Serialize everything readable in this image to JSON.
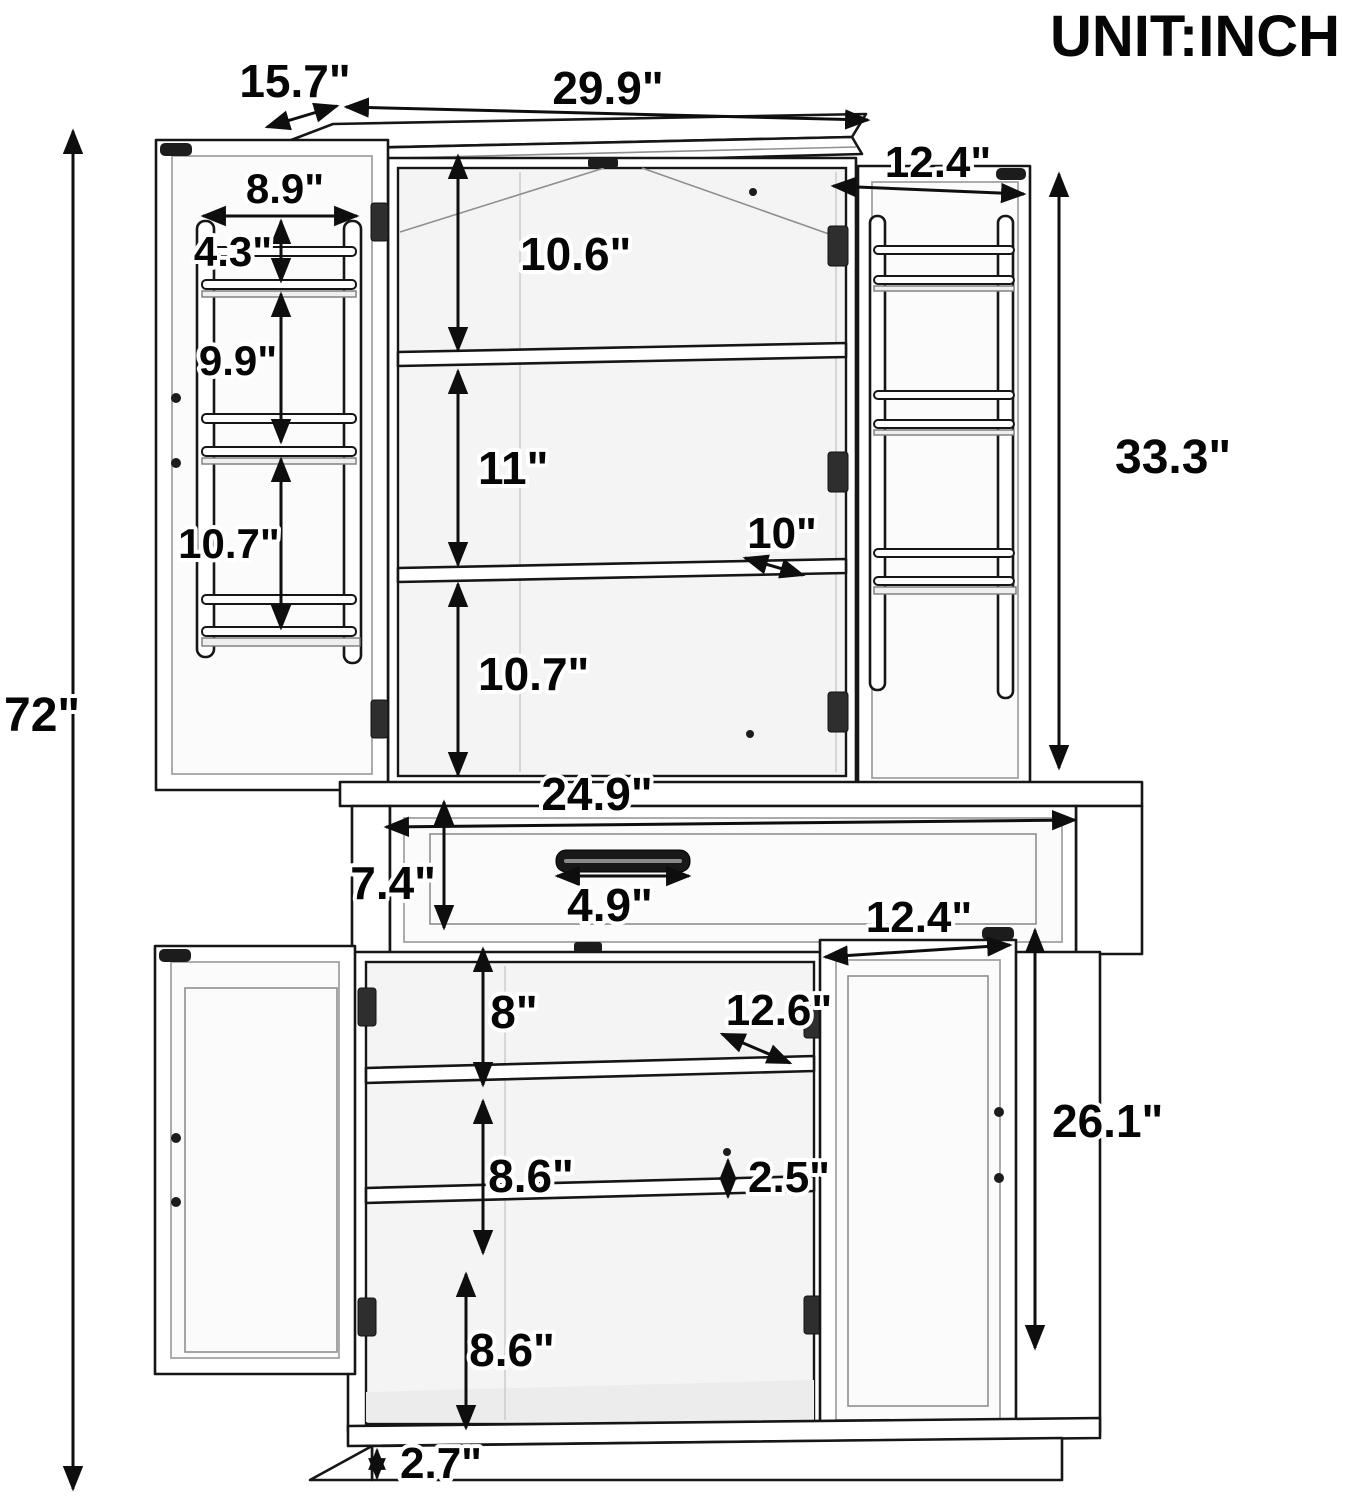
{
  "unit_label": "UNIT:INCH",
  "dimensions": {
    "overall_height": "72\"",
    "top_depth": "15.7\"",
    "top_width": "29.9\"",
    "upper_door_width": "12.4\"",
    "left_rack_width": "8.9\"",
    "left_rack_top": "4.3\"",
    "left_rack_middle": "9.9\"",
    "left_rack_bottom": "10.7\"",
    "upper_section_top": "10.6\"",
    "upper_section_middle": "11\"",
    "upper_shelf_depth": "10\"",
    "upper_section_bottom": "10.7\"",
    "right_door_height": "33.3\"",
    "drawer_width": "24.9\"",
    "drawer_height": "7.4\"",
    "handle_width": "4.9\"",
    "lower_section_top": "8\"",
    "lower_shelf_depth": "12.6\"",
    "lower_door_width": "12.4\"",
    "lower_section_middle": "8.6\"",
    "shelf_gap": "2.5\"",
    "lower_door_height": "26.1\"",
    "lower_section_bottom": "8.6\"",
    "base_height": "2.7\""
  }
}
